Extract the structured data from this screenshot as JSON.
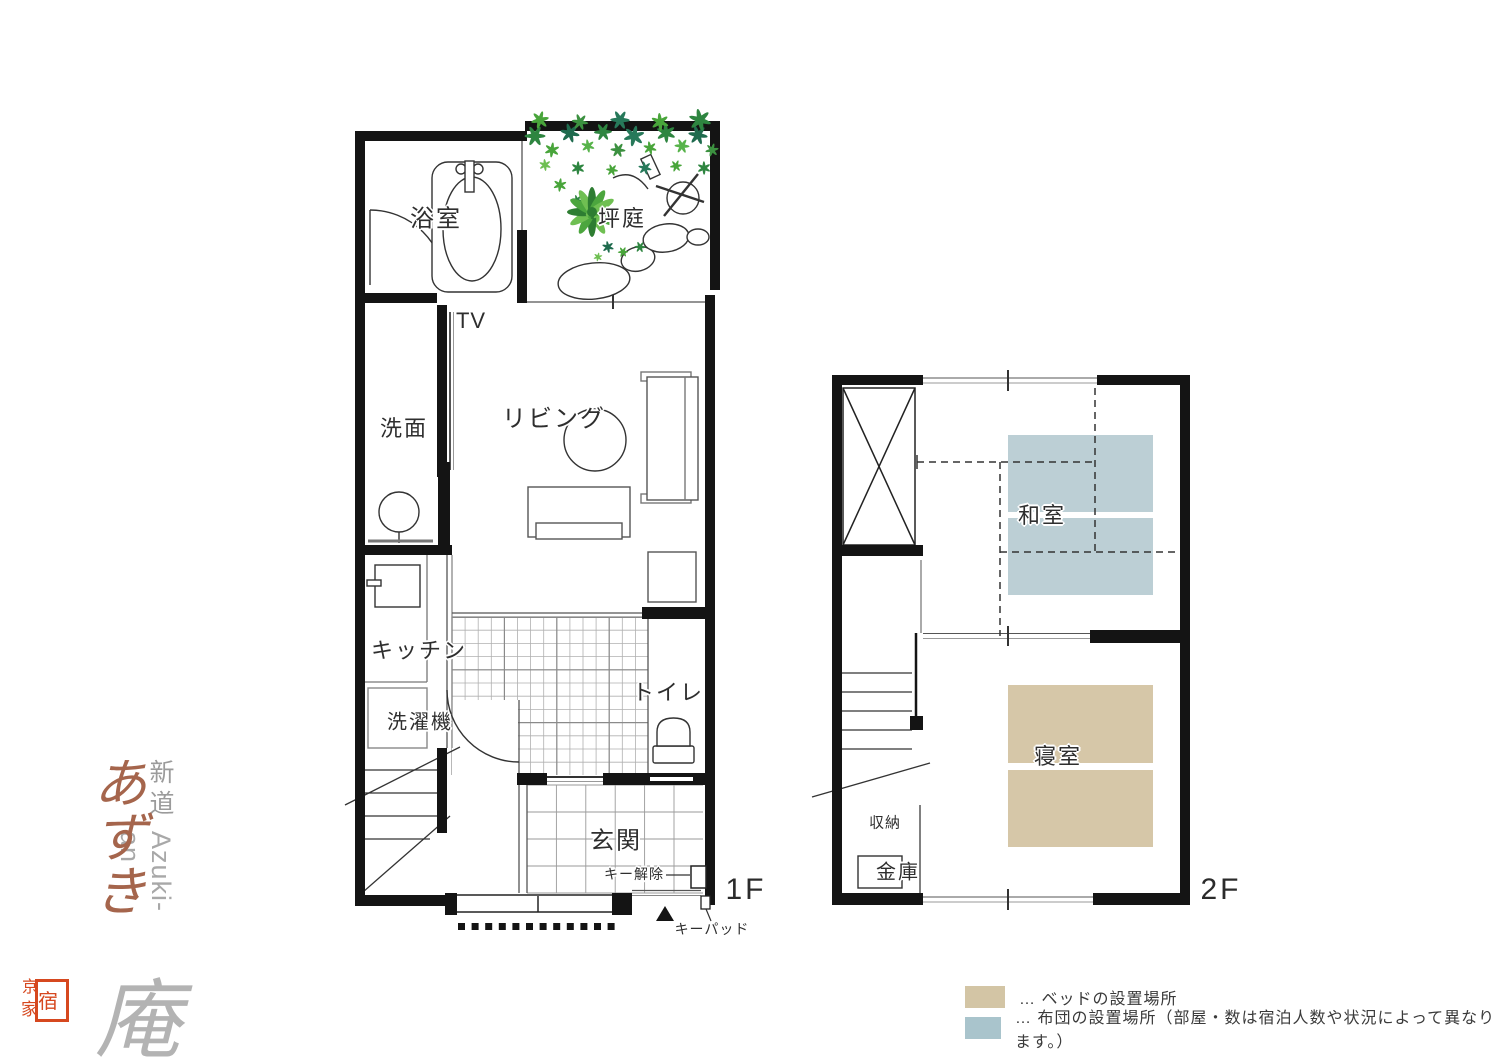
{
  "brand": {
    "subtitle": "新道",
    "romaji": "Azuki-an",
    "name_main": "あずき",
    "name_suffix": "庵",
    "seal": {
      "char_top": "京",
      "char_inside": "宿",
      "char_bottom": "家"
    },
    "colors": {
      "name_main": "#a5654c",
      "seal_red": "#d6481f"
    }
  },
  "floor1": {
    "label": "1F",
    "rooms": {
      "bath": "浴室",
      "garden": "坪庭",
      "tv": "TV",
      "washroom": "洗面",
      "living": "リビング",
      "kitchen": "キッチン",
      "washer": "洗濯機",
      "toilet": "トイレ",
      "entrance": "玄関"
    },
    "annotations": {
      "key_release": "キー解除",
      "keypad": "キーパッド"
    }
  },
  "floor2": {
    "label": "2F",
    "rooms": {
      "japanese_room": "和室",
      "bedroom": "寝室",
      "storage": "収納",
      "safe": "金庫"
    }
  },
  "legend": {
    "items": [
      {
        "swatch_color": "#d3c5a5",
        "label": "… ベッドの設置場所"
      },
      {
        "swatch_color": "#a9c4cc",
        "label": "… 布団の設置場所（部屋・数は宿泊人数や状況によって異なります。）"
      }
    ]
  },
  "colors": {
    "wall": "#141414",
    "bed_fill": "#d6c7a8",
    "futon_fill": "#bccfd5",
    "foliage_green": "#3f9b35"
  }
}
